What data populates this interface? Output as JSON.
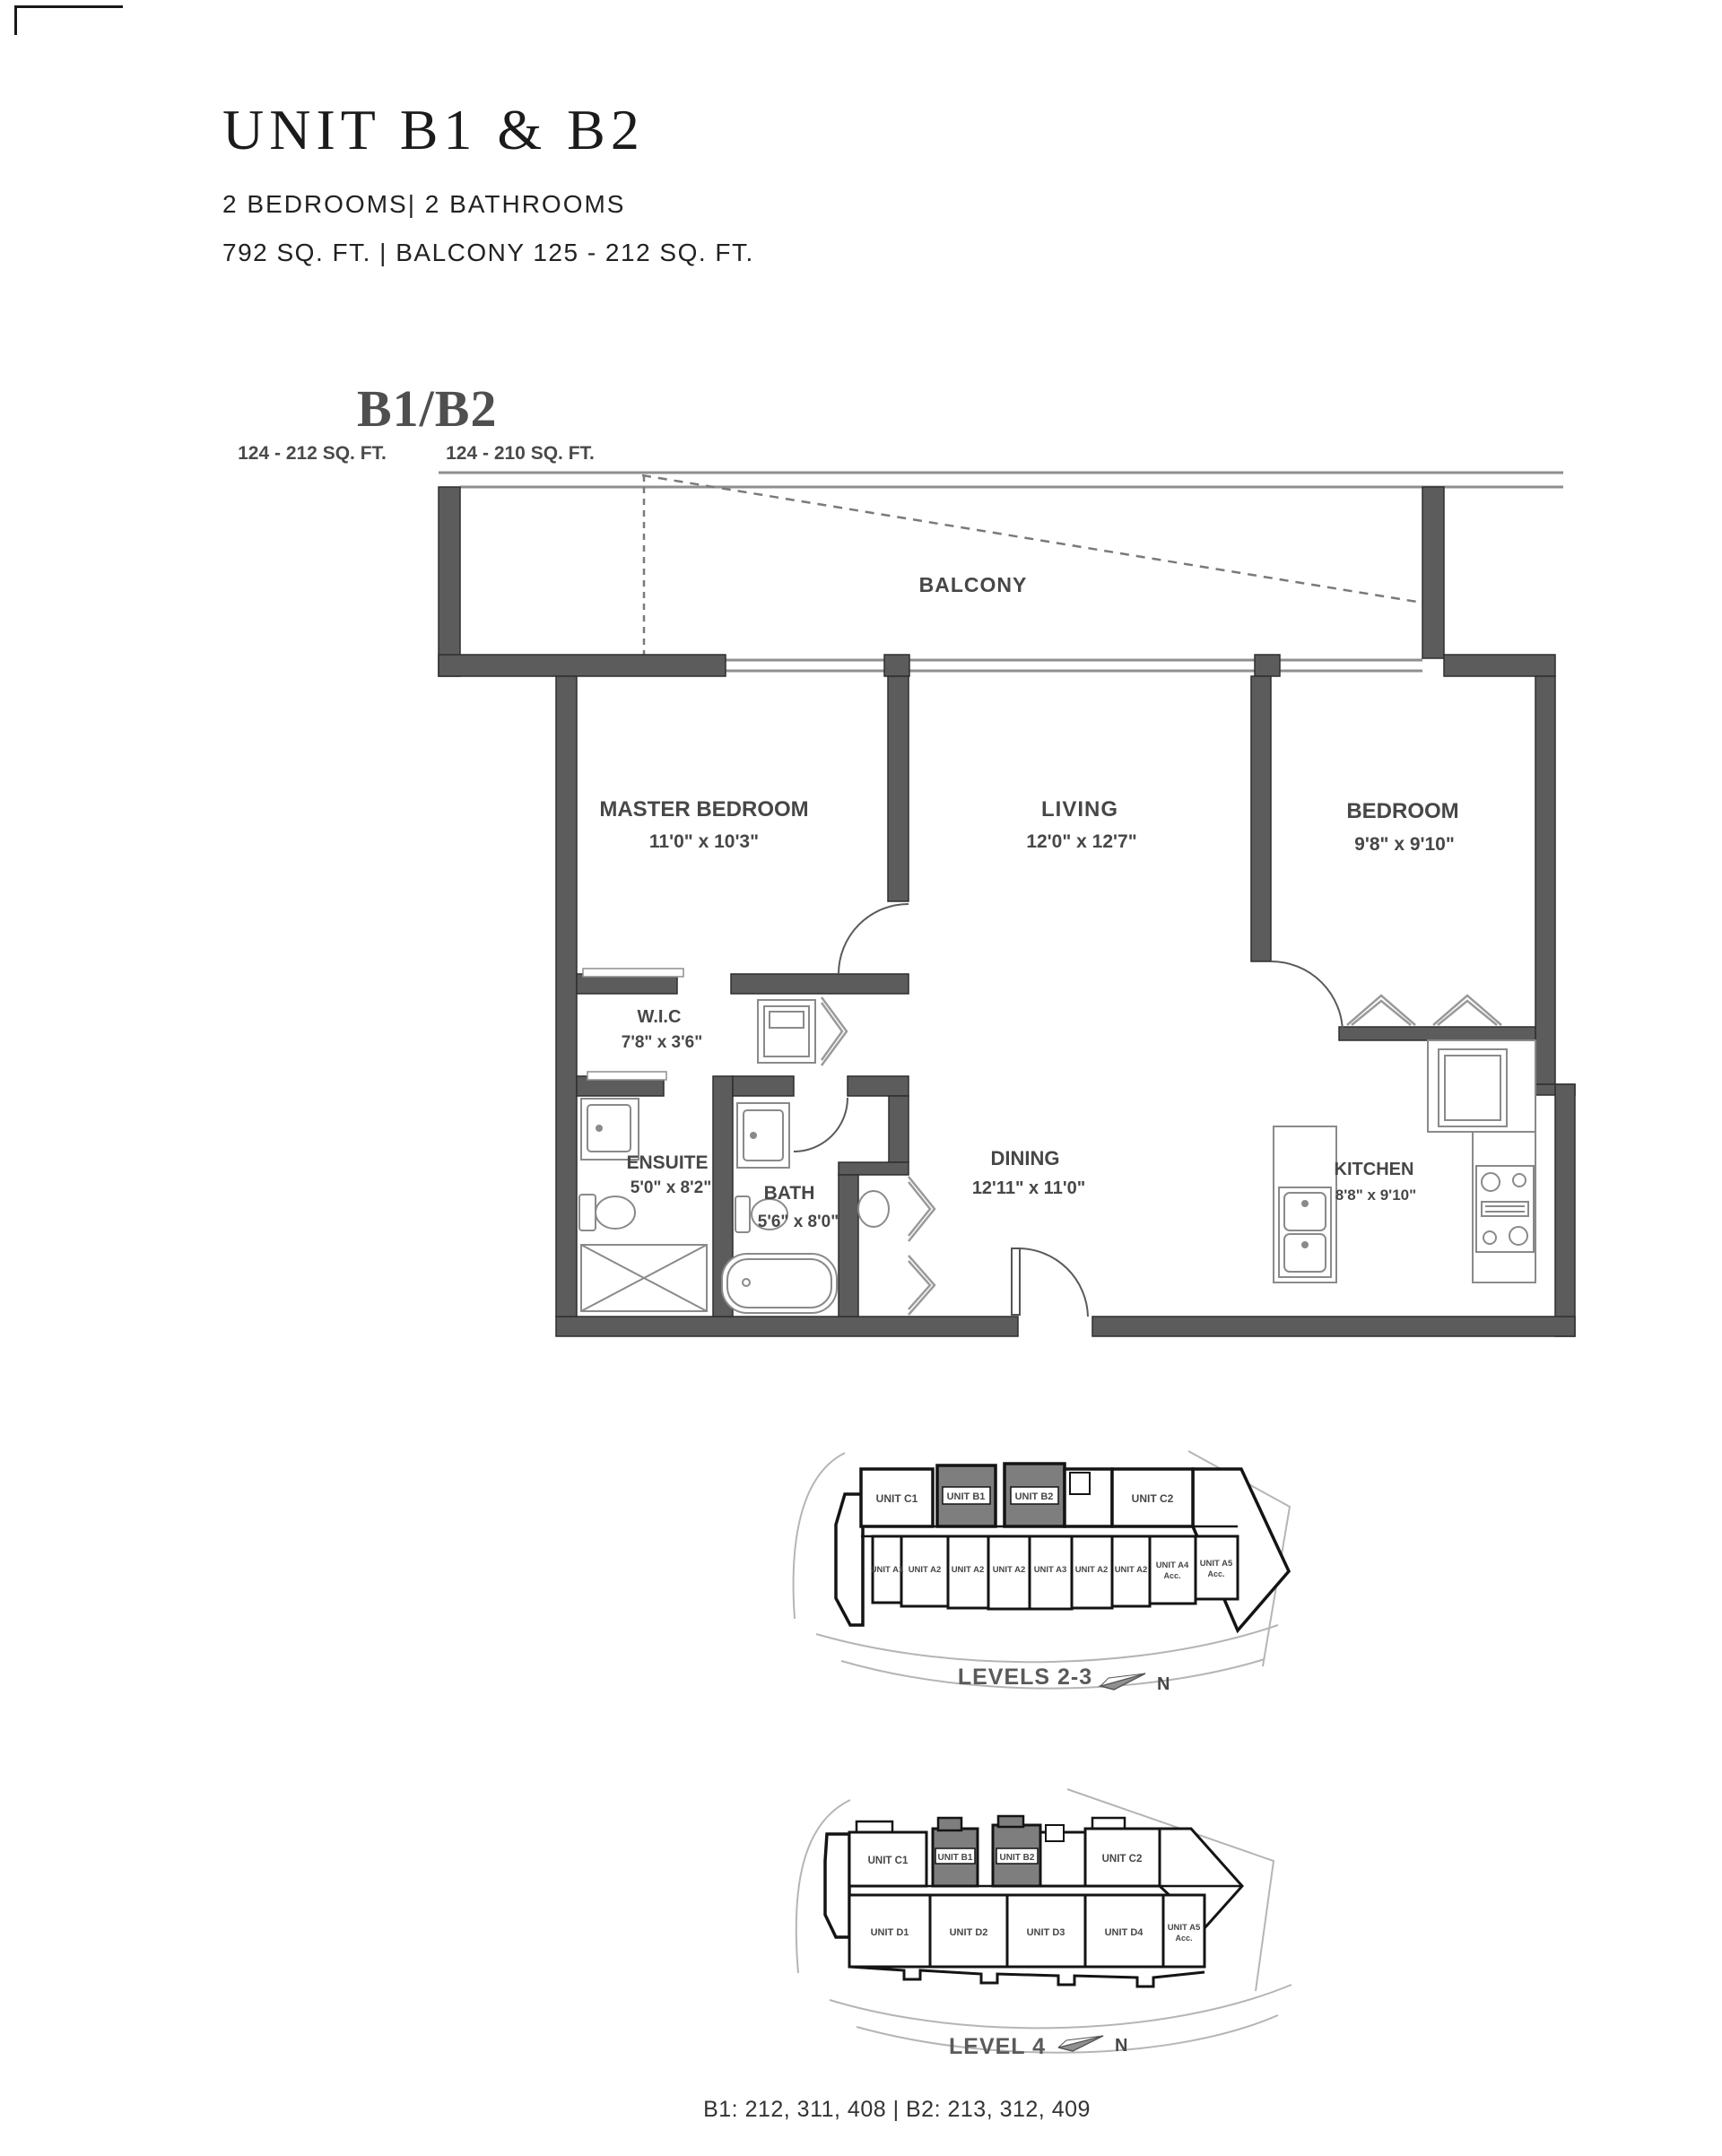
{
  "header": {
    "title": "UNIT B1 & B2",
    "subtitle1": "2 BEDROOMS| 2 BATHROOMS",
    "subtitle2": "792 SQ. FT. | BALCONY 125 - 212 SQ. FT."
  },
  "plan": {
    "name": "B1/B2",
    "area_left": "124 - 212 SQ. FT.",
    "area_right": "124 - 210 SQ. FT.",
    "rooms": {
      "balcony": {
        "name": "BALCONY"
      },
      "master": {
        "name": "MASTER BEDROOM",
        "dims": "11'0\" x 10'3\""
      },
      "living": {
        "name": "LIVING",
        "dims": "12'0\" x 12'7\""
      },
      "bedroom": {
        "name": "BEDROOM",
        "dims": "9'8\" x 9'10\""
      },
      "wic": {
        "name": "W.I.C",
        "dims": "7'8\" x 3'6\""
      },
      "ensuite": {
        "name": "ENSUITE",
        "dims": "5'0\" x 8'2\""
      },
      "bath": {
        "name": "BATH",
        "dims": "5'6\" x 8'0\""
      },
      "dining": {
        "name": "DINING",
        "dims": "12'11\" x 11'0\""
      },
      "kitchen": {
        "name": "KITCHEN",
        "dims": "8'8\" x 9'10\""
      }
    }
  },
  "keyplan_levels23": {
    "caption": "LEVELS 2-3",
    "north": "N",
    "top": [
      {
        "label": "UNIT C1"
      },
      {
        "label": "UNIT B1"
      },
      {
        "label": "UNIT B2"
      },
      {
        "label": "UNIT C2"
      }
    ],
    "bottom": [
      {
        "label": "UNIT A1"
      },
      {
        "label": "UNIT A2"
      },
      {
        "label": "UNIT A2"
      },
      {
        "label": "UNIT A2"
      },
      {
        "label": "UNIT A3"
      },
      {
        "label": "UNIT A2"
      },
      {
        "label": "UNIT A2"
      },
      {
        "label": "UNIT A4",
        "sub": "Acc."
      },
      {
        "label": "UNIT A5",
        "sub": "Acc."
      }
    ]
  },
  "keyplan_level4": {
    "caption": "LEVEL 4",
    "north": "N",
    "top": [
      {
        "label": "UNIT C1"
      },
      {
        "label": "UNIT B1"
      },
      {
        "label": "UNIT B2"
      },
      {
        "label": "UNIT C2"
      }
    ],
    "bottom": [
      {
        "label": "UNIT D1"
      },
      {
        "label": "UNIT D2"
      },
      {
        "label": "UNIT D3"
      },
      {
        "label": "UNIT D4"
      },
      {
        "label": "UNIT A5",
        "sub": "Acc."
      }
    ]
  },
  "footer": {
    "units": "B1: 212, 311, 408 | B2: 213, 312, 409"
  },
  "colors": {
    "wall": "#5c5c5c",
    "highlight": "#7e7e7e",
    "thin_line": "#8f8f8f",
    "outline": "#141414"
  }
}
